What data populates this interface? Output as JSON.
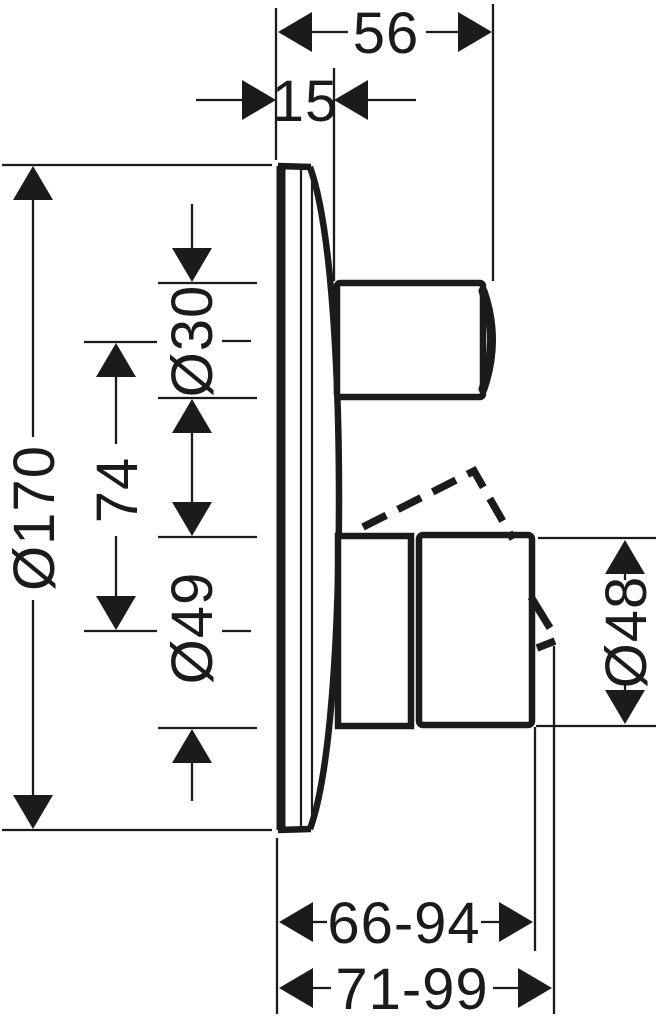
{
  "canvas": {
    "background_color": "#ffffff",
    "line_color": "#1b1b1b"
  },
  "labels": {
    "d56": "56",
    "d15": "15",
    "d170": "Ø170",
    "d74": "74",
    "d30": "Ø30",
    "d49": "Ø49",
    "d48": "Ø48",
    "d66_94": "66-94",
    "d71_99": "71-99"
  }
}
